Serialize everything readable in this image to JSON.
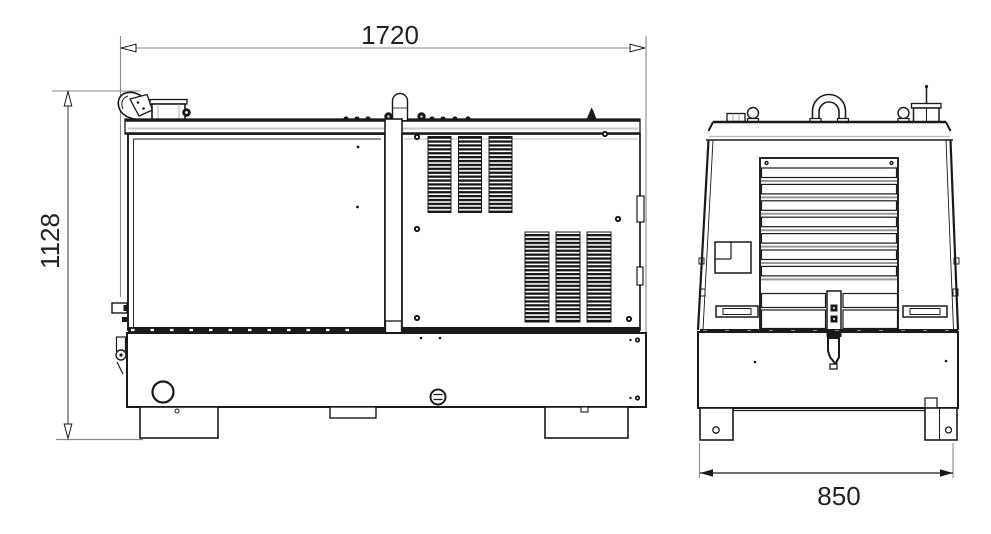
{
  "drawing": {
    "side_view": {
      "length_label": "1720",
      "height_label": "1128"
    },
    "front_view": {
      "width_label": "850"
    }
  },
  "colors": {
    "line": "#1a1a1a",
    "dimension_line": "#8a8a8a",
    "text": "#222222"
  }
}
